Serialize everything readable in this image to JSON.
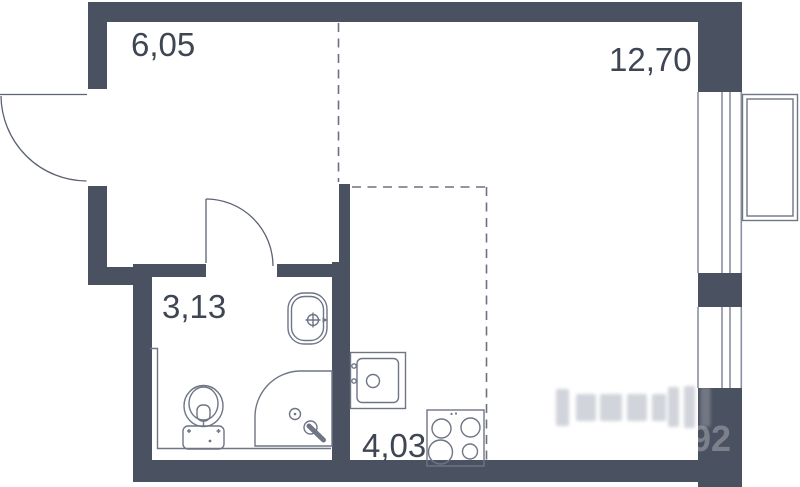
{
  "plan": {
    "kind": "studio-apartment-floor-plan",
    "rooms": {
      "hallway": {
        "area": "6,05"
      },
      "living_room": {
        "area": "12,70"
      },
      "bathroom": {
        "area": "3,13"
      },
      "kitchen": {
        "area": "4,03"
      }
    },
    "watermark": {
      "digits": "92"
    },
    "fixtures": {
      "entrance_door": "door-swing-arc",
      "bathroom_door": "door-swing-arc",
      "bathroom_sink": "washbasin-icon",
      "toilet": "toilet-icon",
      "shower": "corner-shower-icon",
      "kitchen_sink": "kitchen-sink-icon",
      "stove": "stove-4-burner-icon",
      "windows": "double-glazed-window-lines",
      "balcony": "balcony-outline"
    },
    "colors": {
      "wall": "#4a5160",
      "fixture_line": "#6e7585",
      "window_line": "#8a90a0",
      "zone_dash": "#6b7280",
      "label_text": "#3e4553",
      "background": "#ffffff",
      "watermark_marks": "#b3b8c3"
    }
  }
}
